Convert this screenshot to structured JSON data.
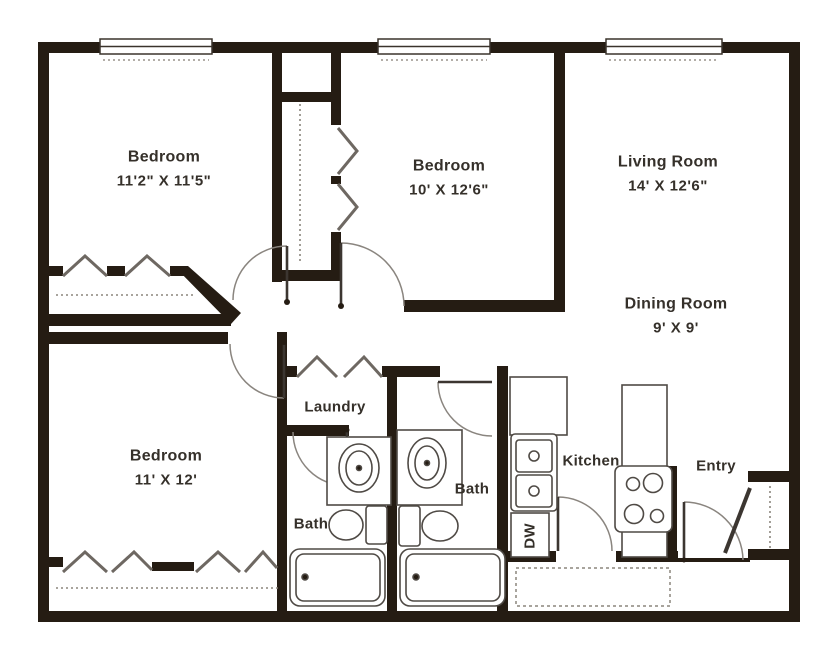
{
  "plan": {
    "rooms": [
      {
        "name": "Bedroom",
        "dims": "11'2\" X 11'5\""
      },
      {
        "name": "Bedroom",
        "dims": "10' X 12'6\""
      },
      {
        "name": "Living Room",
        "dims": "14' X 12'6\""
      },
      {
        "name": "Dining Room",
        "dims": "9' X 9'"
      },
      {
        "name": "Bedroom",
        "dims": "11' X 12'"
      }
    ],
    "areas": {
      "laundry": "Laundry",
      "bath_1": "Bath",
      "bath_2": "Bath",
      "kitchen": "Kitchen",
      "entry": "Entry",
      "dishwasher": "DW"
    },
    "colors": {
      "wall": "#251c13",
      "paper": "#ffffff",
      "fixture_line": "#4f4a45",
      "door_arc": "#8a857f",
      "text": "#35302a"
    },
    "icons": [
      "window",
      "door-swing",
      "bifold-door",
      "closet-shelf-dashed",
      "vanity-sink",
      "toilet",
      "bathtub",
      "kitchen-sink",
      "stove",
      "dishwasher",
      "patio-dashed"
    ]
  }
}
